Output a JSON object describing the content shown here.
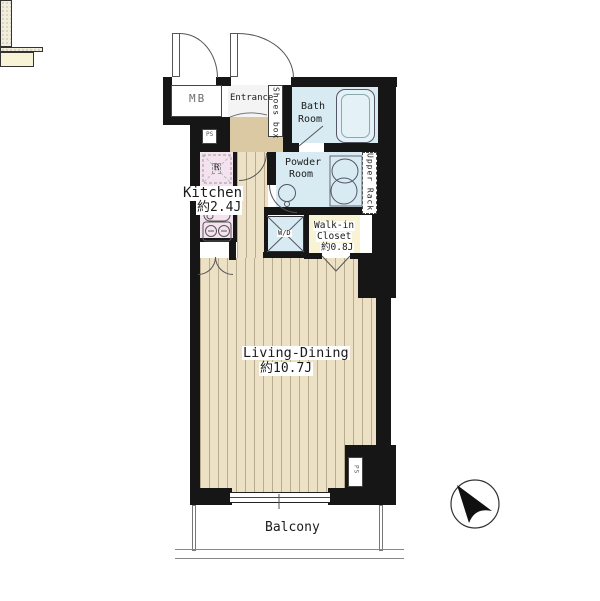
{
  "title": "apartment-floor-plan",
  "rooms": {
    "mb": {
      "label": "MB"
    },
    "ps_top": {
      "label": "PS"
    },
    "entrance": {
      "label": "Entrance"
    },
    "shoes_box": {
      "label": "Shoes box"
    },
    "bath": {
      "line1": "Bath",
      "line2": "Room"
    },
    "powder": {
      "line1": "Powder",
      "line2": "Room"
    },
    "upper_rack": {
      "label": "Upper Rack"
    },
    "kitchen": {
      "label": "Kitchen",
      "size": "約2.4J",
      "fridge": "R"
    },
    "washer": {
      "label": "W/D"
    },
    "walk_in_closet": {
      "line1": "Walk-in",
      "line2": "Closet",
      "size": "約0.8J"
    },
    "living_dining": {
      "label": "Living-Dining",
      "size": "約10.7J"
    },
    "balcony": {
      "label": "Balcony"
    },
    "ps_bottom": {
      "label": "PS"
    }
  },
  "colors": {
    "wall": "#161616",
    "water": "#d9ebf2",
    "tub": "#e4f1f6",
    "kitchen": "#f5e2f0",
    "cream": "#f9f3d6",
    "floor": "#ece0c5",
    "floor_line": "#b9ac8e",
    "hall": "#dbc9a4"
  }
}
